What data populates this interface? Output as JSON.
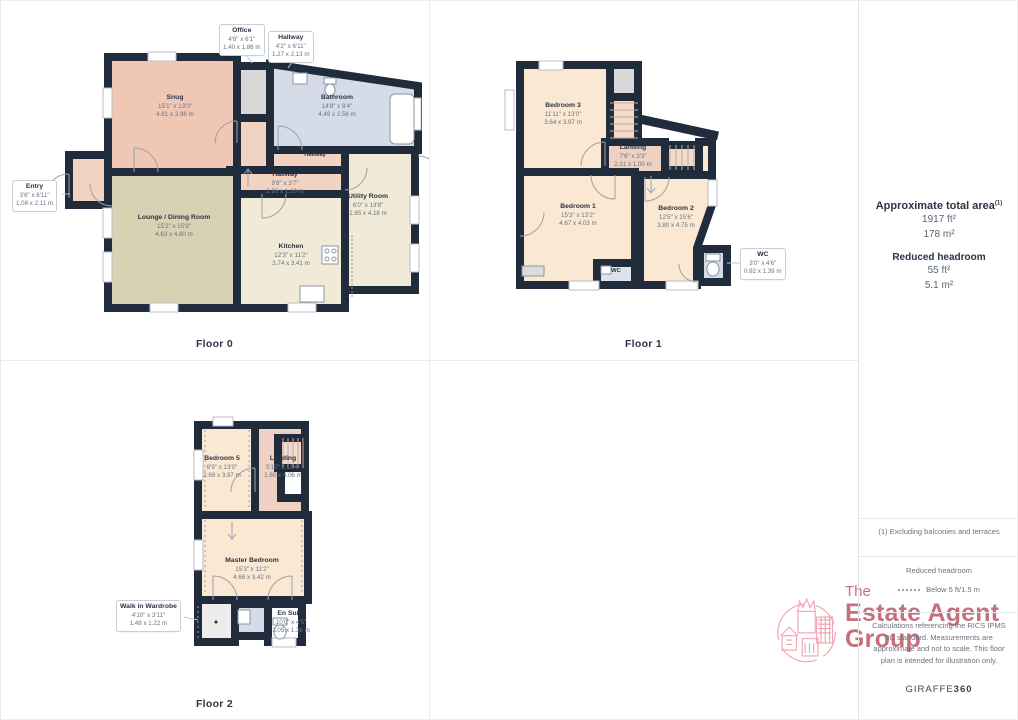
{
  "floors": [
    {
      "label": "Floor 0",
      "rooms": [
        {
          "name": "Snug",
          "ft": "15'1\" x 13'0\"",
          "m": "4.61 x 3.96 m"
        },
        {
          "name": "Bathroom",
          "ft": "14'8\" x 8'4\"",
          "m": "4.49 x 2.56 m"
        },
        {
          "name": "Hallway"
        },
        {
          "name": "Hallway",
          "ft": "9'8\" x 3'7\"",
          "m": "2.95 x 1.10 m"
        },
        {
          "name": "Utility Room",
          "ft": "6'0\" x 13'8\"",
          "m": "1.85 x 4.18 m"
        },
        {
          "name": "Lounge / Dining Room",
          "ft": "15'2\" x 15'9\"",
          "m": "4.63 x 4.80 m"
        },
        {
          "name": "Kitchen",
          "ft": "12'3\" x 11'2\"",
          "m": "3.74 x 3.41 m"
        }
      ],
      "callouts": [
        {
          "name": "Office",
          "ft": "4'6\" x 6'1\"",
          "m": "1.40 x 1.86 m"
        },
        {
          "name": "Hallway",
          "ft": "4'2\" x 6'11\"",
          "m": "1.27 x 2.13 m"
        },
        {
          "name": "Entry",
          "ft": "3'6\" x 6'11\"",
          "m": "1.08 x 2.11 m"
        }
      ]
    },
    {
      "label": "Floor 1",
      "rooms": [
        {
          "name": "Bedroom 3",
          "ft": "11'11\" x 13'0\"",
          "m": "3.64 x 3.97 m"
        },
        {
          "name": "Landing",
          "ft": "7'6\" x 3'3\"",
          "m": "2.31 x 1.00 m"
        },
        {
          "name": "Bedroom 1",
          "ft": "15'3\" x 13'2\"",
          "m": "4.67 x 4.03 m"
        },
        {
          "name": "Bedroom 2",
          "ft": "12'5\" x 15'6\"",
          "m": "3.80 x 4.75 m"
        },
        {
          "name": "WC"
        }
      ],
      "callouts": [
        {
          "name": "WC",
          "ft": "3'0\" x 4'6\"",
          "m": "0.92 x 1.39 m"
        }
      ]
    },
    {
      "label": "Floor 2",
      "rooms": [
        {
          "name": "Bedroom 5",
          "ft": "8'9\" x 13'0\"",
          "m": "2.69 x 3.97 m"
        },
        {
          "name": "Landing",
          "ft": "5'10\" x 13'4\"",
          "m": "1.80 x 4.06 m"
        },
        {
          "name": "Master Bedroom",
          "ft": "15'3\" x 11'2\"",
          "m": "4.66 x 3.42 m"
        },
        {
          "name": "En Suite",
          "ft": "10'0\" x 4'5\"",
          "m": "3.05 x 1.36 m"
        }
      ],
      "callouts": [
        {
          "name": "Walk in Wardrobe",
          "ft": "4'10\" x 3'11\"",
          "m": "1.49 x 1.22 m"
        }
      ]
    }
  ],
  "sidebar": {
    "total_area_title": "Approximate total area",
    "total_area_footnote_mark": "(1)",
    "total_area_ft": "1917 ft²",
    "total_area_m": "178 m²",
    "reduced_headroom_title": "Reduced headroom",
    "reduced_headroom_ft": "55 ft²",
    "reduced_headroom_m": "5.1 m²",
    "footnote": "(1) Excluding balconies and terraces",
    "legend_title": "Reduced headroom",
    "legend_value": "Below 5 ft/1.5 m",
    "disclaimer": "Calculations referencing the RICS IPMS 3C standard. Measurements are approximate and not to scale. This floor plan is intended for illustration only.",
    "brand": "GIRAFFE",
    "brand_suffix": "360"
  },
  "logo": {
    "line1": "The",
    "line2": "Estate Agent",
    "line3": "Group"
  },
  "colors": {
    "wall": "#202b3c",
    "accent_rose": "#c4707f"
  }
}
